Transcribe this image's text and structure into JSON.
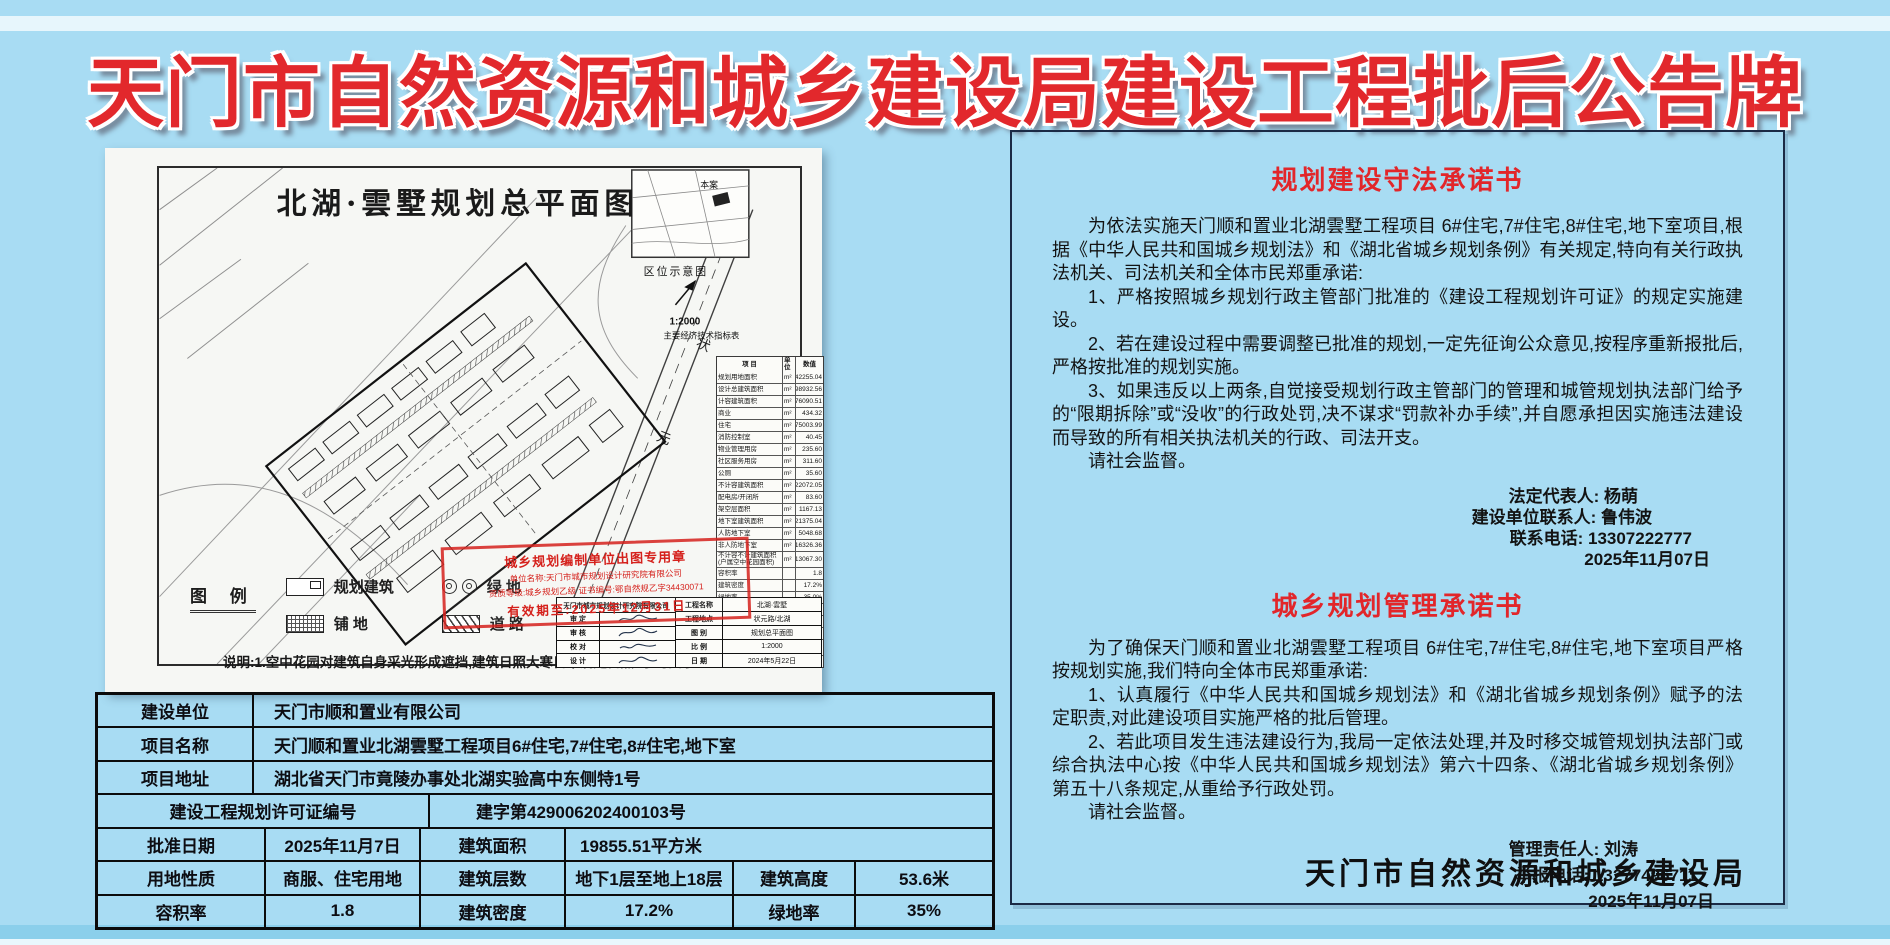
{
  "board": {
    "title": "天门市自然资源和城乡建设局建设工程批后公告牌",
    "agency": "天门市自然资源和城乡建设局",
    "colors": {
      "background": "#a8dcf3",
      "title_red": "#e2282c",
      "panel_border": "#1b2a45",
      "table_border": "#0b0b0b",
      "stamp_red": "#d5211c"
    }
  },
  "site_plan": {
    "title": "北湖·雲墅规划总平面图",
    "inset": {
      "label": "区位示意图",
      "site_marker": "本案",
      "scale": "1:2000",
      "table_title": "主要经济技术指标表"
    },
    "road_labels": {
      "a": "状",
      "b": "元"
    },
    "indicator_table": {
      "header": {
        "name": "项  目",
        "unit": "单位",
        "value": "数值"
      },
      "rows": [
        {
          "n": "规划用地面积",
          "u": "m²",
          "v": "42255.04"
        },
        {
          "n": "设计总建筑面积",
          "u": "m²",
          "v": "98932.56"
        },
        {
          "n": "计容建筑面积",
          "u": "m²",
          "v": "76090.51"
        },
        {
          "n": "商业",
          "u": "m²",
          "v": "434.32"
        },
        {
          "n": "住宅",
          "u": "m²",
          "v": "75003.99"
        },
        {
          "n": "消防控制室",
          "u": "m²",
          "v": "40.45"
        },
        {
          "n": "物业管理用房",
          "u": "m²",
          "v": "235.60"
        },
        {
          "n": "社区服务用房",
          "u": "m²",
          "v": "311.60"
        },
        {
          "n": "公厕",
          "u": "m²",
          "v": "35.60"
        },
        {
          "n": "不计容建筑面积",
          "u": "m²",
          "v": "22072.05"
        },
        {
          "n": "配电房/开闭所",
          "u": "m²",
          "v": "83.60"
        },
        {
          "n": "架空层面积",
          "u": "m²",
          "v": "1167.13"
        },
        {
          "n": "地下室建筑面积",
          "u": "m²",
          "v": "21375.04"
        },
        {
          "n": "人防地下室",
          "u": "m²",
          "v": "5048.68"
        },
        {
          "n": "非人防地下室",
          "u": "m²",
          "v": "16326.36"
        },
        {
          "n": "不计容不计建筑面积 (户属空中花园面积)",
          "u": "m²",
          "v": "13067.30"
        },
        {
          "n": "容积率",
          "u": "",
          "v": "1.8"
        },
        {
          "n": "建筑密度",
          "u": "",
          "v": "17.2%"
        },
        {
          "n": "绿地率",
          "u": "",
          "v": "35.0%"
        },
        {
          "n": "机动车车位数总计",
          "u": "个",
          "v": "588"
        },
        {
          "n": "地上停车位数总计",
          "u": "个",
          "v": "65"
        },
        {
          "n": "地下停车位数总计",
          "u": "个",
          "v": "523"
        },
        {
          "n": "非机动车停车位数总计",
          "u": "个",
          "v": "612"
        },
        {
          "n": "居住户数",
          "u": "户",
          "v": "582"
        }
      ]
    },
    "stamp": {
      "line1": "城乡规划编制单位出图专用章",
      "line2": "单位名称:天门市城市规划设计研究院有限公司",
      "line3": "资质等级:城乡规划乙级 证书编号:鄂自然规乙字34430071",
      "line4": "有效期至:2025年12月31日"
    },
    "title_block": {
      "company": "天门市城市规划设计研究院有限公司",
      "left_rows": [
        "审  定",
        "审  核",
        "校  对",
        "设  计"
      ],
      "fields": [
        {
          "label": "工程名称",
          "value": "北湖·雲墅"
        },
        {
          "label": "工程地点",
          "value": "状元路/北湖"
        },
        {
          "label": "图  别",
          "value": "规划总平面图"
        },
        {
          "label": "比  例",
          "value": "1:2000"
        },
        {
          "label": "日  期",
          "value": "2024年5月22日"
        }
      ]
    },
    "legend": {
      "heading": "图  例",
      "items": [
        {
          "label": "规划建筑",
          "type": "building"
        },
        {
          "label": "绿  地",
          "type": "green"
        },
        {
          "label": "铺  地",
          "type": "paving"
        },
        {
          "label": "道  路",
          "type": "road"
        }
      ]
    },
    "note": "说明:1.空中花园对建筑自身采光形成遮挡,建筑日照大寒日不满足日照3小时要求."
  },
  "info_table": {
    "rows_wide": [
      {
        "label": "建设单位",
        "value": "天门市顺和置业有限公司"
      },
      {
        "label": "项目名称",
        "value": "天门顺和置业北湖雲墅工程项目6#住宅,7#住宅,8#住宅,地下室"
      },
      {
        "label": "项目地址",
        "value": "湖北省天门市竟陵办事处北湖实验高中东侧特1号"
      }
    ],
    "permit_row": {
      "label": "建设工程规划许可证编号",
      "value": "建字第429006202400103号"
    },
    "row5": {
      "l1": "批准日期",
      "v1": "2025年11月7日",
      "l2": "建筑面积",
      "v2": "19855.51平方米"
    },
    "row6": {
      "l1": "用地性质",
      "v1": "商服、住宅用地",
      "l2": "建筑层数",
      "v2": "地下1层至地上18层",
      "l3": "建筑高度",
      "v3": "53.6米"
    },
    "row7": {
      "l1": "容积率",
      "v1": "1.8",
      "l2": "建筑密度",
      "v2": "17.2%",
      "l3": "绿地率",
      "v3": "35%"
    }
  },
  "right_panel": {
    "section1": {
      "title": "规划建设守法承诺书",
      "paragraphs": [
        "为依法实施天门顺和置业北湖雲墅工程项目 6#住宅,7#住宅,8#住宅,地下室项目,根据《中华人民共和国城乡规划法》和《湖北省城乡规划条例》有关规定,特向有关行政执法机关、司法机关和全体市民郑重承诺:",
        "1、严格按照城乡规划行政主管部门批准的《建设工程规划许可证》的规定实施建设。",
        "2、若在建设过程中需要调整已批准的规划,一定先征询公众意见,按程序重新报批后,严格按批准的规划实施。",
        "3、如果违反以上两条,自觉接受规划行政主管部门的管理和城管规划执法部门给予的“限期拆除”或“没收”的行政处罚,决不谋求“罚款补办手续”,并自愿承担因实施违法建设而导致的所有相关执法机关的行政、司法开支。",
        "请社会监督。"
      ],
      "signature": [
        {
          "text": "法定代表人: 杨萌"
        },
        {
          "text": "建设单位联系人: 鲁伟波"
        },
        {
          "text": "联系电话: 13307222777"
        },
        {
          "text": "2025年11月07日"
        }
      ]
    },
    "section2": {
      "title": "城乡规划管理承诺书",
      "paragraphs": [
        "为了确保天门顺和置业北湖雲墅工程项目 6#住宅,7#住宅,8#住宅,地下室项目严格按规划实施,我们特向全体市民郑重承诺:",
        "1、认真履行《中华人民共和国城乡规划法》和《湖北省城乡规划条例》赋予的法定职责,对此建设项目实施严格的批后管理。",
        "2、若此项目发生违法建设行为,我局一定依法处理,并及时移交城管规划执法部门或综合执法中心按《中华人民共和国城乡规划法》第六十四条、《湖北省城乡规划条例》第五十八条规定,从重给予行政处罚。",
        "请社会监督。"
      ],
      "signature": [
        {
          "text": "管理责任人: 刘涛"
        },
        {
          "text": "举报电话: 13277496711"
        },
        {
          "text": "2025年11月07日"
        }
      ]
    }
  }
}
